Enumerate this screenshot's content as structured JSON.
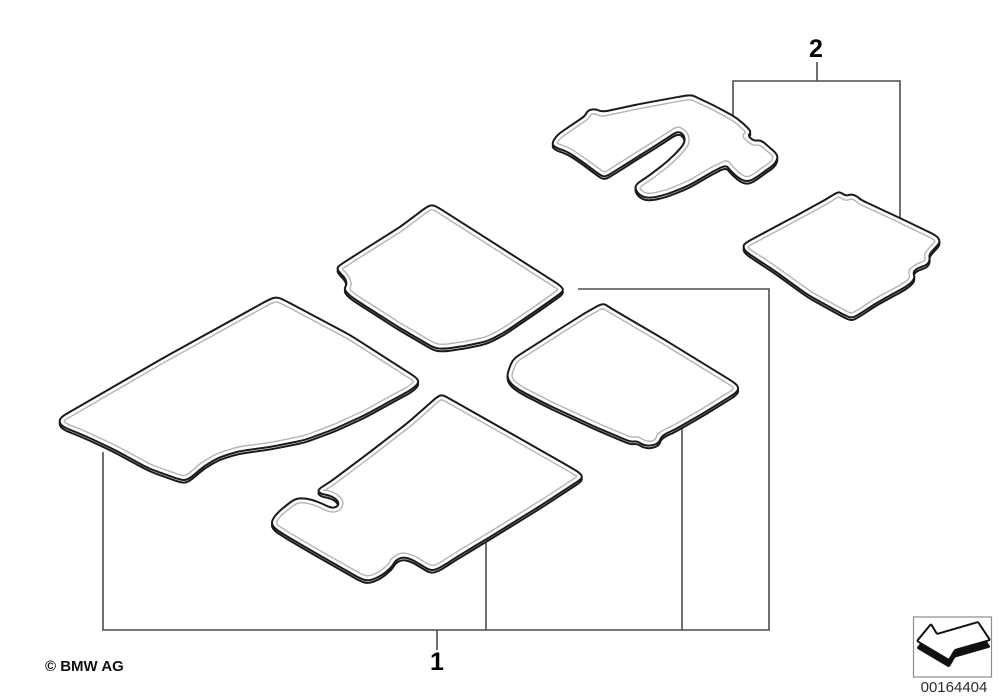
{
  "diagram": {
    "kind": "parts-diagram-floor-mats",
    "mat_count": 6
  },
  "callouts": {
    "item1": "1",
    "item2": "2"
  },
  "footer": {
    "copyright": "© BMW AG",
    "image_number": "00164404",
    "stamp_icon": "direction-arrow-icon"
  },
  "colors": {
    "background": "#ffffff",
    "mat_outline": "#1a1a1a",
    "mat_inner_line": "#b4b4b4",
    "mat_fill": "#ffffff",
    "bracket_line": "#4d4d4d",
    "label_text": "#000000",
    "stamp_border": "#8c8c8c",
    "stamp_ink": "#111111"
  }
}
